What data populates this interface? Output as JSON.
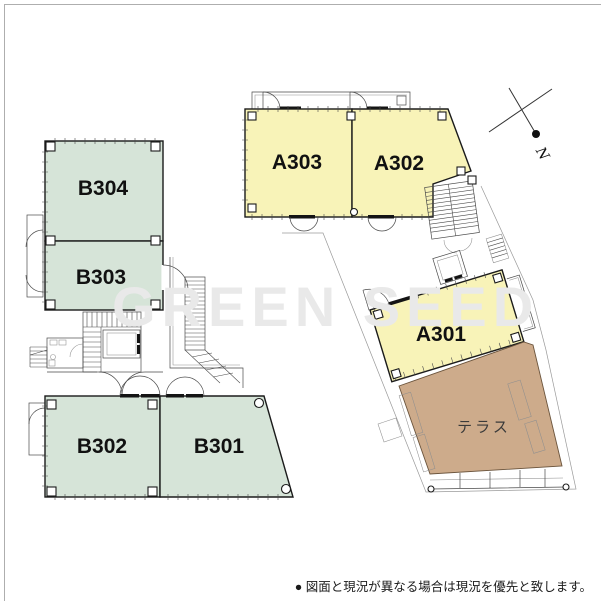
{
  "watermark": {
    "text": "GREEN SEED"
  },
  "compass": {
    "label": "N"
  },
  "footer": {
    "note": "● 図面と現況が異なる場合は現況を優先と致します。"
  },
  "plan": {
    "rooms": [
      {
        "id": "B304",
        "label": "B304",
        "fill": "#d6e4d8",
        "wing": "B"
      },
      {
        "id": "B303",
        "label": "B303",
        "fill": "#d6e4d8",
        "wing": "B"
      },
      {
        "id": "B302",
        "label": "B302",
        "fill": "#d6e4d8",
        "wing": "B"
      },
      {
        "id": "B301",
        "label": "B301",
        "fill": "#d6e4d8",
        "wing": "B"
      },
      {
        "id": "A303",
        "label": "A303",
        "fill": "#f8f3b8",
        "wing": "A"
      },
      {
        "id": "A302",
        "label": "A302",
        "fill": "#f8f3b8",
        "wing": "A"
      },
      {
        "id": "A301",
        "label": "A301",
        "fill": "#f8f3b8",
        "wing": "A"
      }
    ],
    "terrace": {
      "label": "テラス",
      "fill": "#cdab8b"
    },
    "colors": {
      "wall": "#1b1b1b",
      "room_green": "#d6e4d8",
      "room_yellow": "#f8f3b8",
      "terrace_tan": "#cdab8b"
    }
  }
}
